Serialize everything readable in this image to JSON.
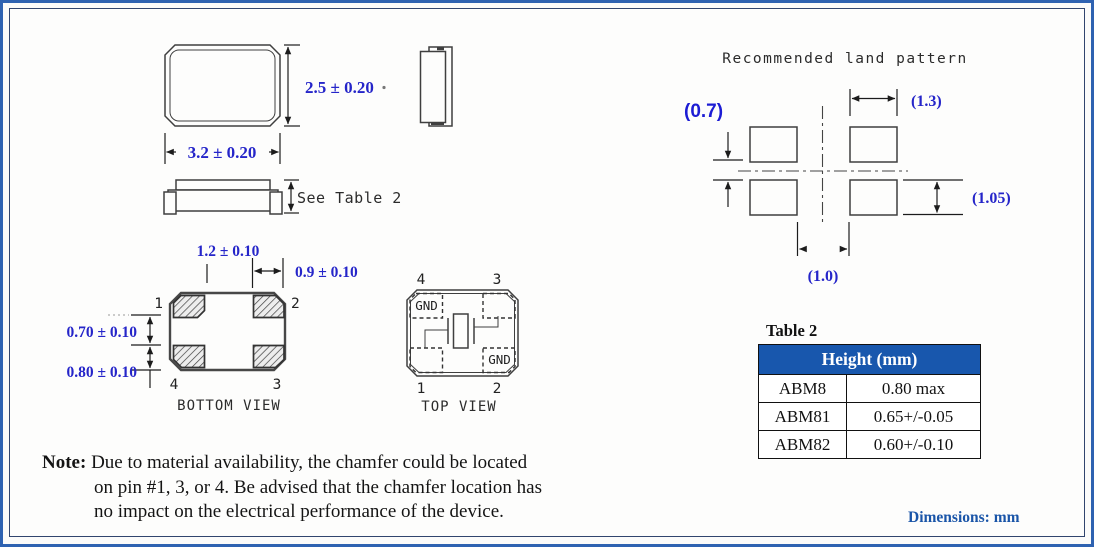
{
  "figure": {
    "units_label": "Dimensions: mm"
  },
  "outline_views": {
    "dim_height": "2.5 ± 0.20",
    "dim_width": "3.2 ± 0.20",
    "side_height_label": "See Table 2"
  },
  "bottom_view": {
    "title": "BOTTOM VIEW",
    "dim_inner_gap": "1.2 ± 0.10",
    "dim_pad_width": "0.9 ± 0.10",
    "dim_row_gap": "0.70 ± 0.10",
    "dim_pad_height": "0.80 ± 0.10",
    "pin1": "1",
    "pin2": "2",
    "pin3": "3",
    "pin4": "4"
  },
  "top_view": {
    "title": "TOP VIEW",
    "gnd": "GND",
    "pin1": "1",
    "pin2": "2",
    "pin3": "3",
    "pin4": "4"
  },
  "land_pattern": {
    "title": "Recommended land pattern",
    "dim_pad_width": "(1.3)",
    "dim_row_gap": "(0.7)",
    "dim_pad_height": "(1.05)",
    "dim_col_gap": "(1.0)"
  },
  "table2": {
    "caption": "Table 2",
    "header": "Height (mm)",
    "rows": [
      {
        "model": "ABM8",
        "height": "0.80 max"
      },
      {
        "model": "ABM81",
        "height": "0.65+/-0.05"
      },
      {
        "model": "ABM82",
        "height": "0.60+/-0.10"
      }
    ]
  },
  "note": {
    "label": "Note:",
    "line1": "Due to material availability, the chamfer could be located",
    "line2": "on pin #1, 3, or 4. Be advised that the chamfer location has",
    "line3": "no impact on the electrical performance of the device."
  },
  "colors": {
    "dimension_blue": "#2525c9",
    "accent_blue": "#1a55a8",
    "table_header_blue": "#1857ad",
    "frame_blue": "#2e62b1",
    "drawing_line": "#3f3f3f"
  }
}
